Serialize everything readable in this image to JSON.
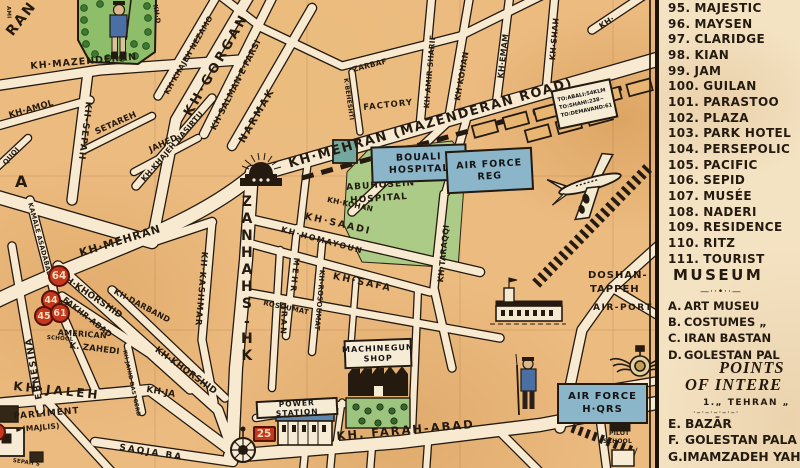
{
  "colors": {
    "ink": "#241a10",
    "map_paper": "#ecbb80",
    "legend_paper": "#f4e3c3",
    "street": "#f8ead0",
    "park_green": "#8fbe6a",
    "hospital_green": "#a9cc88",
    "box_blue": "#8bb5c8",
    "badge_red": "#c6371e"
  },
  "legend": {
    "hotels": [
      {
        "num": "95.",
        "name": "MAJESTIC"
      },
      {
        "num": "96.",
        "name": "MAYSEN"
      },
      {
        "num": "97.",
        "name": "CLARIDGE"
      },
      {
        "num": "98.",
        "name": "KIAN"
      },
      {
        "num": "99.",
        "name": "JAM"
      },
      {
        "num": "100.",
        "name": "GUILAN"
      },
      {
        "num": "101.",
        "name": "PARASTOO"
      },
      {
        "num": "102.",
        "name": "PLAZA"
      },
      {
        "num": "103.",
        "name": "PARK HOTEL"
      },
      {
        "num": "104.",
        "name": "PERSEPOLIC"
      },
      {
        "num": "105.",
        "name": "PACIFIC"
      },
      {
        "num": "106.",
        "name": "SEPID"
      },
      {
        "num": "107.",
        "name": "MUSÉE"
      },
      {
        "num": "108.",
        "name": "NADERI"
      },
      {
        "num": "109.",
        "name": "RESIDENCE"
      },
      {
        "num": "110.",
        "name": "RITZ"
      },
      {
        "num": "111.",
        "name": "TOURIST"
      }
    ],
    "museum_title": "MUSEUM",
    "museum_rule": "—··•··—",
    "museum_items": [
      {
        "letter": "A.",
        "name": "ART MUSEU"
      },
      {
        "letter": "B.",
        "name": "COSTUMES „"
      },
      {
        "letter": "C.",
        "name": "IRAN BASTAN"
      },
      {
        "letter": "D.",
        "name": "GOLESTAN PAL"
      }
    ],
    "points_title_1": "POINTS",
    "points_title_2": "OF INTERE",
    "points_sub": "1.„ TEHRAN „",
    "points_rule": "·–·–·–·–·–·",
    "points_items": [
      {
        "letter": "E.",
        "name": "BAZĀR"
      },
      {
        "letter": "F.",
        "name": "GOLESTAN PALA"
      },
      {
        "letter": "G.",
        "name": "IMAMZADEH YAH"
      }
    ]
  },
  "map": {
    "labels": [
      {
        "t": "RAN",
        "x": 4,
        "y": 30,
        "r": -52,
        "s": 14,
        "ls": 2
      },
      {
        "t": "AMI",
        "x": 10,
        "y": 6,
        "r": 88,
        "s": 5.5
      },
      {
        "t": "KH·MAZENDERAN",
        "x": 30,
        "y": 62,
        "r": -5,
        "s": 9.5,
        "ls": 1
      },
      {
        "t": "KH·AMOL",
        "x": 8,
        "y": 112,
        "r": -16,
        "s": 8.5
      },
      {
        "t": "SETAREH",
        "x": 94,
        "y": 129,
        "r": -24,
        "s": 8.5
      },
      {
        "t": "JAHED",
        "x": 148,
        "y": 147,
        "r": -25,
        "s": 8.5
      },
      {
        "t": "KH·KHAJEH NASIRTU",
        "x": 140,
        "y": 178,
        "r": -49,
        "s": 7.5
      },
      {
        "t": "KH·KHAJEH NEZAMO",
        "x": 163,
        "y": 92,
        "r": -60,
        "s": 7.5
      },
      {
        "t": "KH·GORGAN",
        "x": 182,
        "y": 112,
        "r": -60,
        "s": 13,
        "ls": 3
      },
      {
        "t": "KH·SALMAN·E·FARSI",
        "x": 210,
        "y": 128,
        "r": -63,
        "s": 8.5
      },
      {
        "t": "NARMAK",
        "x": 238,
        "y": 140,
        "r": -60,
        "s": 10,
        "ls": 2
      },
      {
        "t": "ZARBAF",
        "x": 352,
        "y": 66,
        "r": -14,
        "s": 7.5
      },
      {
        "t": "K·BEHESHTI",
        "x": 348,
        "y": 78,
        "r": 82,
        "s": 6
      },
      {
        "t": "FACTORY",
        "x": 363,
        "y": 104,
        "r": -6,
        "s": 8.5,
        "ls": 1
      },
      {
        "t": "KH·AMIR·SHARIF",
        "x": 423,
        "y": 108,
        "r": -85,
        "s": 7.5
      },
      {
        "t": "KH·KOHAN",
        "x": 454,
        "y": 100,
        "r": -80,
        "s": 8
      },
      {
        "t": "KH·EMAM",
        "x": 497,
        "y": 78,
        "r": -83,
        "s": 8
      },
      {
        "t": "KH·SHAH",
        "x": 549,
        "y": 60,
        "r": -85,
        "s": 8
      },
      {
        "t": "KH·",
        "x": 598,
        "y": 24,
        "r": -33,
        "s": 8
      },
      {
        "t": "KH·MEHRAN (MAZENDERAN ROAD)",
        "x": 287,
        "y": 158,
        "r": -16,
        "s": 13,
        "ls": 1.5
      },
      {
        "t": "KH·MEHRAN",
        "x": 78,
        "y": 248,
        "r": -17,
        "s": 11,
        "ls": 1
      },
      {
        "t": "A",
        "x": 15,
        "y": 174,
        "r": 0,
        "s": 16
      },
      {
        "t": "QUQI",
        "x": 2,
        "y": 162,
        "r": -48,
        "s": 7
      },
      {
        "t": "KAMALE ASADABADI",
        "x": 33,
        "y": 202,
        "r": 75,
        "s": 6.5
      },
      {
        "t": "KH-SEPAH",
        "x": 92,
        "y": 102,
        "r": 97,
        "s": 9,
        "ls": 1
      },
      {
        "t": "EBNESINA",
        "x": 36,
        "y": 400,
        "r": -100,
        "s": 9,
        "ls": 1.5
      },
      {
        "t": "KH·KHORSHID",
        "x": 62,
        "y": 272,
        "r": 34,
        "s": 9
      },
      {
        "t": "KH·KHORSHID",
        "x": 158,
        "y": 346,
        "r": 36,
        "s": 9
      },
      {
        "t": "KH·DARBAND",
        "x": 116,
        "y": 288,
        "r": 28,
        "s": 8
      },
      {
        "t": "FAKHR·ABAD",
        "x": 66,
        "y": 296,
        "r": 38,
        "s": 8
      },
      {
        "t": "AMERICAN",
        "x": 58,
        "y": 329,
        "r": 4,
        "s": 8
      },
      {
        "t": "SCHOOL",
        "x": 47,
        "y": 336,
        "r": 4,
        "s": 5.5
      },
      {
        "t": "K. ZAHEDI",
        "x": 70,
        "y": 342,
        "r": 7,
        "s": 8.5
      },
      {
        "t": "KH·JAHID DASTGERD",
        "x": 126,
        "y": 350,
        "r": 78,
        "s": 5.5
      },
      {
        "t": "KH·JALEH",
        "x": 14,
        "y": 380,
        "r": 6,
        "s": 12,
        "ls": 3
      },
      {
        "t": "KH·JA",
        "x": 147,
        "y": 386,
        "r": 10,
        "s": 9
      },
      {
        "t": "PARLIMENT",
        "x": 13,
        "y": 413,
        "r": -5,
        "s": 9,
        "ls": 1
      },
      {
        "t": "►(MAJLIS)",
        "x": 16,
        "y": 426,
        "r": -5,
        "s": 7.5
      },
      {
        "t": "SEPAH S",
        "x": 13,
        "y": 459,
        "r": 8,
        "s": 5.5
      },
      {
        "t": "SAQJA BA",
        "x": 120,
        "y": 444,
        "r": 9,
        "s": 9,
        "ls": 2
      },
      {
        "t": "KH·KASHMAR",
        "x": 208,
        "y": 252,
        "r": 95,
        "s": 8.5,
        "ls": 1
      },
      {
        "t": "KH-SHAHNAZ",
        "x": 241,
        "y": 194,
        "s": 14,
        "st": "up"
      },
      {
        "t": "MEHR",
        "x": 300,
        "y": 258,
        "r": 96,
        "s": 8,
        "ls": 2.5
      },
      {
        "t": "IRAN",
        "x": 288,
        "y": 306,
        "r": 93,
        "s": 8,
        "ls": 2
      },
      {
        "t": "KH-ROSOUMAT",
        "x": 325,
        "y": 270,
        "r": 95,
        "s": 7
      },
      {
        "t": "ROSOUMAT",
        "x": 264,
        "y": 300,
        "r": 12,
        "s": 7
      },
      {
        "t": "KH·HOMAYOUN",
        "x": 282,
        "y": 226,
        "r": 15,
        "s": 8,
        "ls": 1.5
      },
      {
        "t": "KH·SAADI",
        "x": 306,
        "y": 212,
        "r": 13,
        "s": 9.5,
        "ls": 2
      },
      {
        "t": "KH·KOHAN",
        "x": 328,
        "y": 196,
        "r": 12,
        "s": 7.5
      },
      {
        "t": "KH·SAFA",
        "x": 334,
        "y": 272,
        "r": 12,
        "s": 9.5,
        "ls": 2
      },
      {
        "t": "KH·TARAQQI",
        "x": 437,
        "y": 282,
        "r": -84,
        "s": 8
      },
      {
        "t": "KH. FARAH-ABAD",
        "x": 336,
        "y": 430,
        "r": -5,
        "s": 11.5,
        "ls": 2
      },
      {
        "t": "ABUHOSEIN",
        "x": 346,
        "y": 184,
        "r": -4,
        "s": 9,
        "ls": 1
      },
      {
        "t": "HOSPITAL",
        "x": 350,
        "y": 197,
        "r": -4,
        "s": 9,
        "ls": 1
      },
      {
        "t": "DOSHAN-",
        "x": 588,
        "y": 271,
        "s": 10,
        "ls": 1
      },
      {
        "t": "TAPPEH",
        "x": 590,
        "y": 285,
        "s": 10,
        "ls": 1
      },
      {
        "t": "AIR-PORT",
        "x": 593,
        "y": 304,
        "s": 9,
        "ls": 1.5
      },
      {
        "t": "PILOT",
        "x": 609,
        "y": 431,
        "s": 6
      },
      {
        "t": "SCHOOL",
        "x": 603,
        "y": 439,
        "s": 6
      },
      {
        "t": "KH·D",
        "x": 158,
        "y": 4,
        "r": 80,
        "s": 6.5
      },
      {
        "t": "★",
        "x": 63,
        "y": 300,
        "s": 9
      }
    ],
    "boxes": [
      {
        "lines": [
          "BOUALI",
          "HOSPITAL"
        ],
        "x": 371,
        "y": 145,
        "w": 92,
        "h": 33,
        "r": -2,
        "bg": "blue",
        "fs": 9.5,
        "name": "bouali-hospital-box"
      },
      {
        "lines": [
          "AIR FORCE",
          "REG"
        ],
        "x": 446,
        "y": 149,
        "w": 83,
        "h": 39,
        "r": -3,
        "bg": "blue",
        "fs": 9.5,
        "name": "air-force-reg-box"
      },
      {
        "lines": [
          "AIR FORCE",
          "H·QRS"
        ],
        "x": 557,
        "y": 383,
        "w": 87,
        "h": 37,
        "r": 0,
        "bg": "blue",
        "fs": 10,
        "name": "air-force-hqrs-box"
      },
      {
        "lines": [
          "MACHINEGUN",
          "SHOP"
        ],
        "x": 344,
        "y": 339,
        "w": 64,
        "h": 25,
        "r": -2,
        "bg": "paper",
        "fs": 8,
        "name": "machinegun-shop-box"
      },
      {
        "lines": [
          "POWER STATION"
        ],
        "x": 256,
        "y": 399,
        "w": 78,
        "h": 14,
        "r": -3,
        "bg": "paper",
        "fs": 7.5,
        "name": "power-station-box"
      },
      {
        "lines": [
          "TO:ABALI:54KLM",
          "TO:SHAHI:238~",
          "TO:DEMAVAND:61"
        ],
        "x": 554,
        "y": 84,
        "w": 54,
        "h": 36,
        "r": -12,
        "bg": "paper",
        "fs": 5.2,
        "left": true,
        "name": "destinations-sign-box"
      }
    ],
    "badges": [
      {
        "t": "64",
        "cx": 59,
        "cy": 276,
        "rad": 11
      },
      {
        "t": "44",
        "cx": 51,
        "cy": 300,
        "rad": 10
      },
      {
        "t": "45",
        "cx": 44,
        "cy": 316,
        "rad": 10
      },
      {
        "t": "61",
        "cx": 60,
        "cy": 313,
        "rad": 10
      },
      {
        "t": "",
        "cx": -3,
        "cy": 432,
        "rad": 9
      },
      {
        "t": "25",
        "cx": 264,
        "cy": 434,
        "rad": 11,
        "sq": true
      }
    ]
  }
}
